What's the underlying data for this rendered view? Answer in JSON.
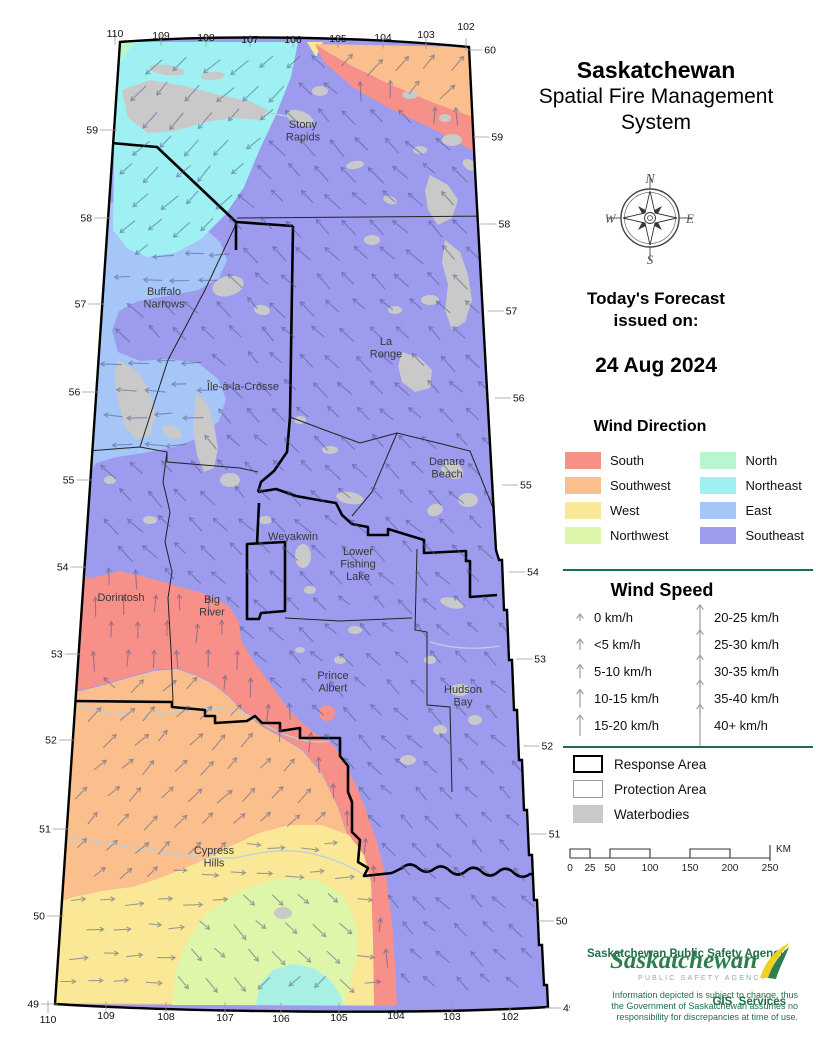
{
  "title": {
    "line1": "Saskatchewan",
    "line2": "Spatial Fire Management",
    "line3": "System"
  },
  "compass": {
    "n": "N",
    "e": "E",
    "s": "S",
    "w": "W"
  },
  "forecast": {
    "heading1": "Today's Forecast",
    "heading2": "issued on:",
    "date": "24 Aug 2024"
  },
  "wind_direction": {
    "heading": "Wind Direction",
    "entries": [
      {
        "label": "South",
        "color": "#F8908A",
        "bearing": 0
      },
      {
        "label": "Southwest",
        "color": "#FBBF8D",
        "bearing": 45
      },
      {
        "label": "West",
        "color": "#FBE897",
        "bearing": 90
      },
      {
        "label": "Northwest",
        "color": "#DDF6A9",
        "bearing": 135
      },
      {
        "label": "North",
        "color": "#B9F5CD",
        "bearing": 180
      },
      {
        "label": "Northeast",
        "color": "#9FF0F2",
        "bearing": 225
      },
      {
        "label": "East",
        "color": "#A6C6F7",
        "bearing": 270
      },
      {
        "label": "Southeast",
        "color": "#9D9BEE",
        "bearing": 315
      }
    ]
  },
  "wind_speed": {
    "heading": "Wind Speed",
    "left": [
      {
        "label": "0 km/h",
        "len": 7
      },
      {
        "label": "<5 km/h",
        "len": 11
      },
      {
        "label": "5-10 km/h",
        "len": 14
      },
      {
        "label": "10-15 km/h",
        "len": 18
      },
      {
        "label": "15-20 km/h",
        "len": 21
      }
    ],
    "right": [
      {
        "label": "20-25 km/h",
        "len": 25
      },
      {
        "label": "25-30 km/h",
        "len": 29
      },
      {
        "label": "30-35 km/h",
        "len": 33
      },
      {
        "label": "35-40 km/h",
        "len": 37
      },
      {
        "label": "40+ km/h",
        "len": 42
      }
    ]
  },
  "area_legend": {
    "response": "Response Area",
    "protection": "Protection Area",
    "waterbodies": "Waterbodies"
  },
  "scale_bar": {
    "ticks": [
      "0",
      "25",
      "50",
      "100",
      "150",
      "200",
      "250"
    ],
    "unit": "KM"
  },
  "map": {
    "place_labels": [
      {
        "lines": [
          "Stony",
          "Rapids"
        ],
        "x": 303,
        "y": 128
      },
      {
        "lines": [
          "Buffalo",
          "Narrows"
        ],
        "x": 164,
        "y": 295
      },
      {
        "lines": [
          "La",
          "Ronge"
        ],
        "x": 386,
        "y": 345
      },
      {
        "lines": [
          "Île-à-la-Crosse"
        ],
        "x": 243,
        "y": 390
      },
      {
        "lines": [
          "Denare",
          "Beach"
        ],
        "x": 447,
        "y": 465
      },
      {
        "lines": [
          "Weyakwin"
        ],
        "x": 293,
        "y": 540
      },
      {
        "lines": [
          "Lower",
          "Fishing",
          "Lake"
        ],
        "x": 358,
        "y": 555
      },
      {
        "lines": [
          "Dorintosh"
        ],
        "x": 121,
        "y": 601
      },
      {
        "lines": [
          "Big",
          "River"
        ],
        "x": 212,
        "y": 603
      },
      {
        "lines": [
          "Prince",
          "Albert"
        ],
        "x": 333,
        "y": 679
      },
      {
        "lines": [
          "Hudson",
          "Bay"
        ],
        "x": 463,
        "y": 693
      },
      {
        "lines": [
          "Cypress",
          "Hills"
        ],
        "x": 214,
        "y": 854
      }
    ],
    "lat_left": [
      [
        "59",
        130
      ],
      [
        "58",
        218
      ],
      [
        "57",
        304
      ],
      [
        "56",
        392
      ],
      [
        "55",
        480
      ],
      [
        "54",
        567
      ],
      [
        "53",
        654
      ],
      [
        "52",
        740
      ],
      [
        "51",
        829
      ],
      [
        "50",
        916
      ],
      [
        "49",
        1004
      ]
    ],
    "lat_right": [
      [
        "60",
        50
      ],
      [
        "59",
        137
      ],
      [
        "58",
        224
      ],
      [
        "57",
        311
      ],
      [
        "56",
        398
      ],
      [
        "55",
        485
      ],
      [
        "54",
        572
      ],
      [
        "53",
        659
      ],
      [
        "52",
        746
      ],
      [
        "51",
        834
      ],
      [
        "50",
        921
      ],
      [
        "49",
        1008
      ]
    ],
    "lon_top": [
      [
        "110",
        115,
        37
      ],
      [
        "109",
        161,
        39
      ],
      [
        "108",
        206,
        41
      ],
      [
        "107",
        250,
        43
      ],
      [
        "106",
        293,
        43
      ],
      [
        "105",
        338,
        42
      ],
      [
        "104",
        383,
        41
      ],
      [
        "103",
        426,
        38
      ],
      [
        "102",
        466,
        30
      ]
    ],
    "lon_bottom": [
      [
        "110",
        48,
        1023
      ],
      [
        "109",
        106,
        1019
      ],
      [
        "108",
        166,
        1020
      ],
      [
        "107",
        225,
        1021
      ],
      [
        "106",
        281,
        1022
      ],
      [
        "105",
        339,
        1021
      ],
      [
        "104",
        396,
        1019
      ],
      [
        "103",
        452,
        1020
      ],
      [
        "102",
        510,
        1020
      ]
    ]
  },
  "footer": {
    "agency1": "Saskatchewan Public Safety Agency",
    "agency2": "GIS  Services",
    "logo_text": "Saskatchewan",
    "logo_sub": "PUBLIC SAFETY AGENCY",
    "disclaimer": [
      "Information depicted is subject to change, thus",
      "the Government of Saskatchewan assumes no",
      "responsibility for discrepancies at time of use."
    ]
  },
  "colors": {
    "separator": "#1E6B52",
    "agency_text": "#1F6F4A",
    "logo_green": "#2F7D4E",
    "logo_sub_green": "#8FAF9A",
    "swoosh_yellow": "#F2CF1C",
    "water": "#C9C9C9",
    "map_ne_patch": "#A9F0E4",
    "arrow": "#4B5A85",
    "border": "#000000"
  }
}
